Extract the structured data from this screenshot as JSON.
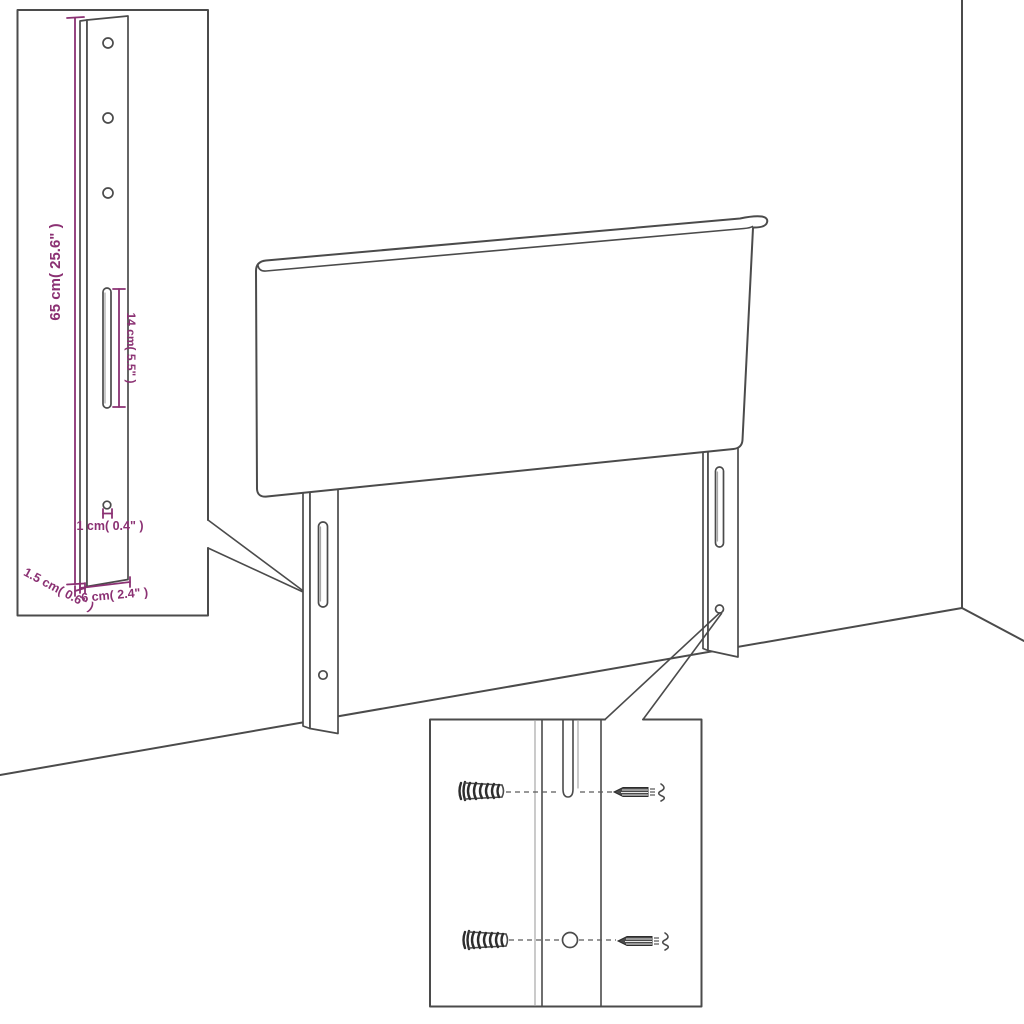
{
  "colors": {
    "background": "#ffffff",
    "outline": "#4b4b4b",
    "outline_light": "#a8a8a8",
    "dimension_accent": "#8b3173"
  },
  "leg_detail": {
    "height": "65 cm( 25.6\" )",
    "slot_length": "14 cm( 5.5\" )",
    "hole_diameter": "1 cm( 0.4\" )",
    "thickness": "1.5 cm( 0.6\" )",
    "width": "6 cm( 2.4\" )"
  },
  "icons": {
    "wall_plug": "wall-plug-icon",
    "screw": "screw-icon"
  }
}
